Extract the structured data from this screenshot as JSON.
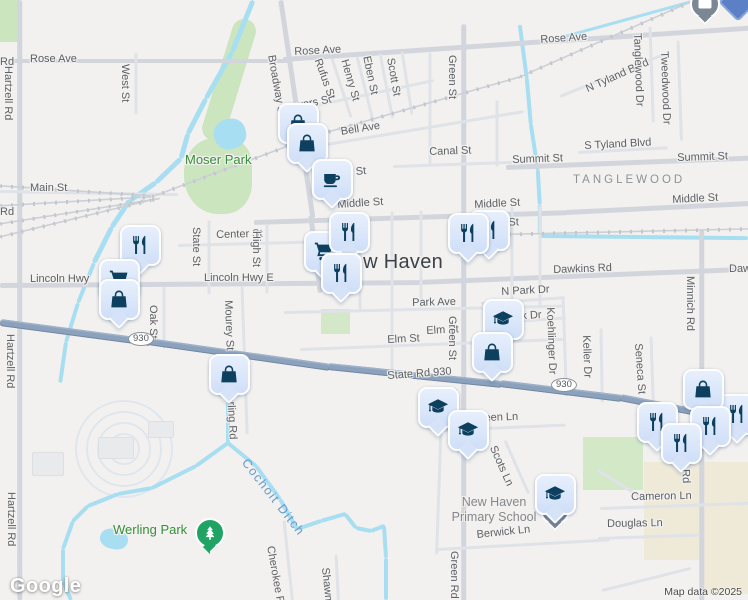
{
  "logo": "Google",
  "attribution": "Map data ©2025",
  "city": {
    "t": "New Haven",
    "x": 337,
    "y": 251
  },
  "areas": [
    {
      "t": "Moser Park",
      "x": 185,
      "y": 152,
      "c": "park-lbl"
    },
    {
      "t": "TANGLEWOOD",
      "x": 573,
      "y": 174,
      "c": "hood-lbl"
    },
    {
      "t": "Werling Park",
      "x": 113,
      "y": 522,
      "c": "park-lbl"
    }
  ],
  "school": {
    "l1": "New Haven",
    "l2": "Primary School",
    "x": 414,
    "y": 495,
    "w": 160
  },
  "water_label": {
    "t": "Cochoit Ditch",
    "x": 250,
    "y": 456,
    "r": 52
  },
  "shields": [
    {
      "t": "930",
      "x": 128,
      "y": 332
    },
    {
      "t": "930",
      "x": 551,
      "y": 378
    }
  ],
  "streets": [
    [
      "Rose Ave",
      30,
      53,
      0
    ],
    [
      "Rd",
      0,
      56,
      0
    ],
    [
      "Rose Ave",
      294,
      46,
      -3
    ],
    [
      "Rose Ave",
      540,
      34,
      -4
    ],
    [
      "Main St",
      30,
      182,
      0
    ],
    [
      "Rd",
      0,
      206,
      0
    ],
    [
      "Powers St",
      281,
      103,
      -11
    ],
    [
      "Bell Ave",
      340,
      126,
      -9
    ],
    [
      "Canal St",
      429,
      146,
      -2
    ],
    [
      "Summit St",
      512,
      154,
      -2
    ],
    [
      "Summit St",
      677,
      152,
      -2
    ],
    [
      "S Tyland Blvd",
      584,
      140,
      -3
    ],
    [
      "N Tyland Blvd",
      584,
      84,
      -24
    ],
    [
      "Middle St",
      337,
      199,
      -4
    ],
    [
      "Middle St",
      474,
      199,
      -3
    ],
    [
      "Middle St",
      672,
      194,
      -3
    ],
    [
      "n St",
      499,
      217,
      -2
    ],
    [
      "n St",
      346,
      167,
      -6
    ],
    [
      "Center St",
      216,
      229,
      -1.5
    ],
    [
      "Lincoln Hwy",
      30,
      273,
      0
    ],
    [
      "Lincoln Hwy E",
      204,
      272,
      0
    ],
    [
      "Dawkins Rd",
      553,
      264,
      -2
    ],
    [
      "Daw",
      729,
      263,
      0
    ],
    [
      "Park Ave",
      412,
      297,
      -1.5
    ],
    [
      "N Park Dr",
      501,
      286,
      -3
    ],
    [
      "Park Dr",
      504,
      311,
      -3
    ],
    [
      "Elm St",
      387,
      334,
      -3
    ],
    [
      "Elm St",
      426,
      325,
      -3
    ],
    [
      "State Rd 930",
      387,
      370,
      -4
    ],
    [
      "Aberdeen Ln",
      455,
      413,
      -2
    ],
    [
      "Cameron Ln",
      631,
      491,
      -1
    ],
    [
      "Douglas Ln",
      607,
      518,
      -1
    ],
    [
      "Berwick Ln",
      476,
      529,
      -6
    ],
    [
      "Hartzell Rd",
      14,
      66,
      90
    ],
    [
      "Hartzell Rd",
      16,
      334,
      90
    ],
    [
      "Hartzell Rd",
      17,
      492,
      90
    ],
    [
      "West St",
      131,
      64,
      90
    ],
    [
      "Broadway St",
      277,
      54,
      80
    ],
    [
      "Rufus St",
      323,
      57,
      70
    ],
    [
      "Henry St",
      350,
      58,
      74
    ],
    [
      "Eben St",
      372,
      55,
      78
    ],
    [
      "Scott St",
      396,
      57,
      80
    ],
    [
      "An",
      322,
      133,
      78
    ],
    [
      "Green St",
      458,
      55,
      90
    ],
    [
      "Green St",
      458,
      316,
      90
    ],
    [
      "Green St",
      459,
      388,
      90
    ],
    [
      "Green Rd",
      460,
      551,
      90
    ],
    [
      "Tanglewood Dr",
      643,
      33,
      88
    ],
    [
      "Tweedwood Dr",
      670,
      51,
      88
    ],
    [
      "State St",
      202,
      227,
      90
    ],
    [
      "High St",
      262,
      231,
      90
    ],
    [
      "Oak St",
      159,
      305,
      90
    ],
    [
      "Mourey St",
      234,
      300,
      88
    ],
    [
      "Werling Rd",
      236,
      385,
      87
    ],
    [
      "Cherokee Rd",
      276,
      545,
      80
    ],
    [
      "Shawn",
      331,
      567,
      84
    ],
    [
      "Koehlinger Dr",
      556,
      307,
      88
    ],
    [
      "Keller Dr",
      592,
      335,
      88
    ],
    [
      "Seneca St",
      644,
      343,
      86
    ],
    [
      "Minnich Rd",
      696,
      276,
      90
    ],
    [
      "Minnich Rd",
      690,
      428,
      88
    ],
    [
      "Scots Ln",
      498,
      444,
      66
    ]
  ],
  "markers": [
    [
      "bag",
      296,
      121
    ],
    [
      "bag",
      305,
      141
    ],
    [
      "coffee",
      330,
      177
    ],
    [
      "fork",
      138,
      243
    ],
    [
      "cart",
      117,
      277
    ],
    [
      "bag",
      117,
      297
    ],
    [
      "cart",
      322,
      249
    ],
    [
      "fork",
      347,
      230
    ],
    [
      "fork",
      339,
      271
    ],
    [
      "fork",
      487,
      228
    ],
    [
      "fork",
      466,
      231
    ],
    [
      "grad",
      501,
      317
    ],
    [
      "bag",
      490,
      350
    ],
    [
      "bag",
      227,
      372
    ],
    [
      "grad",
      436,
      405
    ],
    [
      "grad",
      466,
      428
    ],
    [
      "fork",
      735,
      412
    ],
    [
      "bag",
      701,
      387
    ],
    [
      "fork",
      655,
      420
    ],
    [
      "fork",
      708,
      424
    ],
    [
      "fork",
      679,
      441
    ],
    [
      "grad",
      553,
      492
    ]
  ],
  "pins": [
    [
      "envelope",
      703,
      2
    ],
    [
      "diamond",
      736,
      0
    ],
    [
      "school-dot",
      553,
      508
    ],
    [
      "tree",
      208,
      531
    ]
  ],
  "geometry": {
    "roads": [
      [
        0,
        61,
        292,
        0,
        "r3"
      ],
      [
        283,
        59,
        270,
        -3.9,
        "r3"
      ],
      [
        549,
        41,
        202,
        -3.8,
        "r3"
      ],
      [
        0,
        285,
        420,
        -0.4,
        "r3"
      ],
      [
        418,
        282,
        334,
        -2.3,
        "r3"
      ],
      [
        20,
        0,
        600,
        90,
        "r3"
      ],
      [
        464,
        24,
        578,
        90,
        "r3"
      ],
      [
        702,
        230,
        372,
        90,
        "r3"
      ],
      [
        506,
        167,
        244,
        -2.2,
        "r3"
      ],
      [
        254,
        222,
        314,
        -1.8,
        "r3"
      ],
      [
        566,
        212,
        184,
        -2.8,
        "r3"
      ],
      [
        281,
        0,
        220,
        81.6,
        "r3"
      ],
      [
        311,
        215,
        78,
        83,
        "r3"
      ],
      [
        0,
        191,
        178,
        1,
        "r2"
      ],
      [
        291,
        150,
        236,
        -9.5,
        "r2"
      ],
      [
        283,
        112,
        154,
        -12,
        "r2"
      ],
      [
        393,
        166,
        132,
        -2,
        "r2"
      ],
      [
        578,
        152,
        90,
        -3,
        "r2"
      ],
      [
        560,
        96,
        112,
        -22,
        "r2"
      ],
      [
        178,
        245,
        136,
        -1.5,
        "r2"
      ],
      [
        284,
        312,
        280,
        -1.3,
        "r2"
      ],
      [
        481,
        303,
        84,
        -4,
        "r2"
      ],
      [
        500,
        322,
        66,
        -4,
        "r2"
      ],
      [
        300,
        349,
        264,
        -2.2,
        "r2"
      ],
      [
        440,
        430,
        126,
        -2.5,
        "r2"
      ],
      [
        600,
        508,
        150,
        -2,
        "r2"
      ],
      [
        598,
        538,
        102,
        -2,
        "r2"
      ],
      [
        438,
        549,
        172,
        -3.2,
        "r2"
      ],
      [
        602,
        590,
        92,
        -14,
        "r2"
      ],
      [
        136,
        52,
        62,
        90,
        "r2"
      ],
      [
        332,
        58,
        62,
        72,
        "r2"
      ],
      [
        357,
        56,
        68,
        76,
        "r2"
      ],
      [
        380,
        53,
        66,
        79,
        "r2"
      ],
      [
        402,
        51,
        64,
        81,
        "r2"
      ],
      [
        209,
        220,
        74,
        90,
        "r2"
      ],
      [
        267,
        223,
        70,
        90,
        "r2"
      ],
      [
        164,
        286,
        62,
        90,
        "r2"
      ],
      [
        242,
        286,
        148,
        88,
        "r2"
      ],
      [
        284,
        520,
        82,
        84,
        "r2"
      ],
      [
        336,
        554,
        48,
        87,
        "r2"
      ],
      [
        563,
        296,
        100,
        88,
        "r2"
      ],
      [
        601,
        328,
        74,
        89,
        "r2"
      ],
      [
        651,
        336,
        66,
        88,
        "r2"
      ],
      [
        650,
        26,
        96,
        88,
        "r2"
      ],
      [
        678,
        40,
        100,
        88,
        "r2"
      ],
      [
        360,
        213,
        98,
        90,
        "r2"
      ],
      [
        392,
        211,
        162,
        90,
        "r2"
      ],
      [
        421,
        210,
        100,
        90,
        "r2"
      ],
      [
        512,
        205,
        104,
        90,
        "r2"
      ],
      [
        540,
        205,
        100,
        90,
        "r2"
      ],
      [
        430,
        52,
        112,
        90,
        "r2"
      ],
      [
        497,
        100,
        66,
        90,
        "r2"
      ],
      [
        441,
        428,
        126,
        92,
        "r2"
      ],
      [
        505,
        440,
        58,
        66,
        "r2"
      ],
      [
        598,
        470,
        52,
        32,
        "r2"
      ]
    ],
    "hwy": [
      [
        0,
        322,
        152,
        7.6
      ],
      [
        148,
        341,
        184,
        8.1
      ],
      [
        328,
        366,
        175,
        5.9
      ],
      [
        500,
        383,
        123,
        7
      ],
      [
        620,
        397,
        84,
        11
      ],
      [
        700,
        412,
        54,
        21.8
      ]
    ],
    "rails": [
      [
        0,
        186,
        152,
        3.8
      ],
      [
        0,
        206,
        152,
        -3.4
      ],
      [
        0,
        224,
        162,
        -9
      ],
      [
        0,
        237,
        156,
        -13.7
      ],
      [
        152,
        197,
        177,
        -20.5
      ],
      [
        318,
        135,
        210,
        -16
      ],
      [
        520,
        77,
        197,
        -23.7
      ],
      [
        487,
        235,
        262,
        -1.3
      ]
    ],
    "water": [
      [
        253,
        0,
        56,
        112,
        5
      ],
      [
        232,
        52,
        53,
        119.5,
        5
      ],
      [
        206,
        98,
        40,
        117.2,
        5
      ],
      [
        188,
        133,
        26,
        105.6,
        5
      ],
      [
        181,
        158,
        35,
        136.2,
        5
      ],
      [
        156,
        182,
        32,
        145.3,
        5
      ],
      [
        130,
        200,
        33,
        123.7,
        4.5
      ],
      [
        112,
        227,
        40,
        116.6,
        4.5
      ],
      [
        94,
        263,
        43,
        111.8,
        4
      ],
      [
        78,
        303,
        41,
        107.1,
        4
      ],
      [
        66,
        342,
        41,
        98.1,
        4
      ],
      [
        228,
        402,
        41,
        90,
        4
      ],
      [
        228,
        443,
        40,
        144.3,
        4
      ],
      [
        196,
        466,
        50,
        153.4,
        4
      ],
      [
        152,
        488,
        35,
        170,
        4
      ],
      [
        118,
        494,
        33,
        158.2,
        4
      ],
      [
        88,
        506,
        22,
        135,
        4
      ],
      [
        73,
        521,
        30,
        109.7,
        4
      ],
      [
        63,
        549,
        32,
        90,
        4
      ],
      [
        63,
        581,
        21,
        67.2,
        4
      ],
      [
        228,
        443,
        37,
        39.4,
        4
      ],
      [
        256,
        466,
        41,
        54,
        4
      ],
      [
        280,
        499,
        35,
        60.5,
        4
      ],
      [
        297,
        529,
        26,
        -18.4,
        4
      ],
      [
        321,
        521,
        26,
        -16.3,
        4
      ],
      [
        345,
        514,
        18,
        51.8,
        4
      ],
      [
        356,
        528,
        16,
        11.3,
        4
      ],
      [
        371,
        531,
        15,
        -21,
        4
      ],
      [
        384,
        526,
        32,
        86.4,
        4
      ],
      [
        386,
        558,
        42,
        90,
        4
      ],
      [
        520,
        25,
        54,
        82.5,
        3.5
      ],
      [
        527,
        78,
        47,
        85,
        3.5
      ],
      [
        531,
        124,
        47,
        81.3,
        3.5
      ],
      [
        538,
        170,
        35,
        86.7,
        3.5
      ],
      [
        540,
        205,
        29,
        90,
        3.5
      ],
      [
        540,
        236,
        208,
        0.6,
        3.5
      ],
      [
        543,
        42,
        159,
        -15.4,
        3
      ]
    ],
    "parks": [
      {
        "x": 0,
        "y": 0,
        "w": 20,
        "h": 42,
        "c": "green"
      },
      {
        "x": 236,
        "y": 16,
        "w": 24,
        "h": 126,
        "c": "green",
        "rot": 17,
        "br": "12px"
      },
      {
        "x": 184,
        "y": 138,
        "w": 68,
        "h": 76,
        "c": "green",
        "br": "45% 35% 40% 50%"
      },
      {
        "x": 583,
        "y": 437,
        "w": 60,
        "h": 53,
        "c": "green2"
      },
      {
        "x": 644,
        "y": 462,
        "w": 104,
        "h": 98,
        "c": "beige"
      },
      {
        "x": 700,
        "y": 556,
        "w": 48,
        "h": 38,
        "c": "beige"
      },
      {
        "x": 321,
        "y": 309,
        "w": 29,
        "h": 25,
        "c": "green2"
      }
    ],
    "ponds": [
      {
        "x": 214,
        "y": 119,
        "w": 32,
        "h": 30,
        "rot": -15
      },
      {
        "x": 100,
        "y": 529,
        "w": 28,
        "h": 20,
        "rot": 12
      }
    ],
    "buildings": [
      [
        98,
        437,
        34,
        20
      ],
      [
        32,
        452,
        30,
        22
      ],
      [
        148,
        421,
        24,
        15
      ]
    ],
    "circles": {
      "cx": 122,
      "cy": 447,
      "radii": [
        14,
        25,
        36,
        47
      ]
    }
  }
}
